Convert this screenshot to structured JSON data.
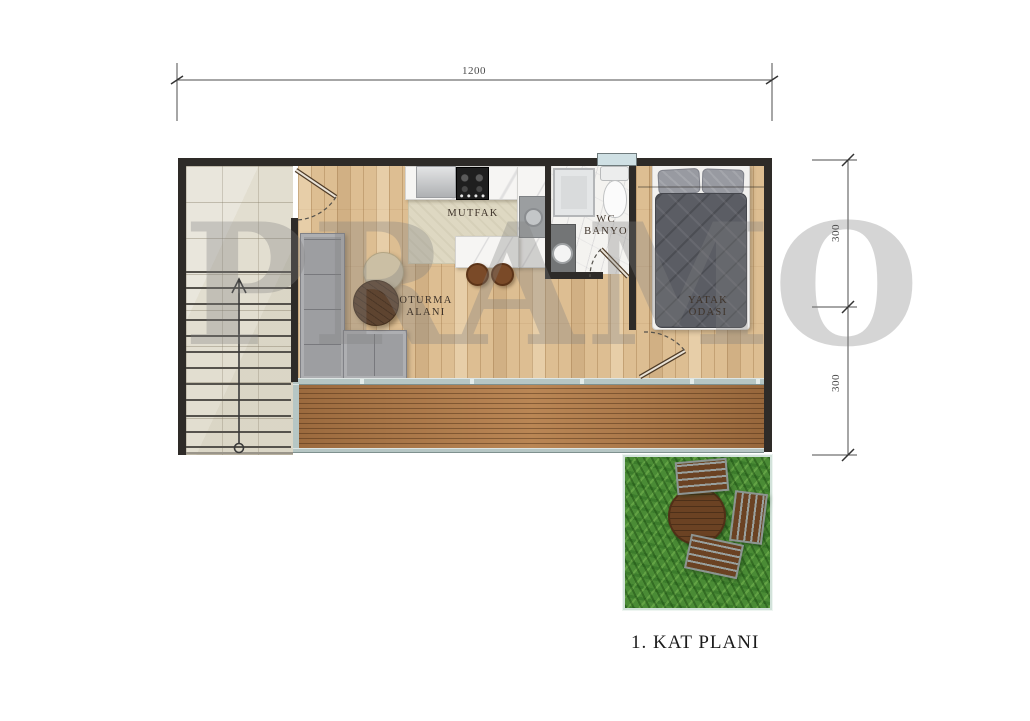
{
  "plan": {
    "watermark": "PRAMO",
    "title": "1. KAT PLANI",
    "rooms": {
      "kitchen": "MUTFAK",
      "wc_line1": "WC",
      "wc_line2": "BANYO",
      "living_line1": "OTURMA",
      "living_line2": "ALANI",
      "bedroom_line1": "YATAK",
      "bedroom_line2": "ODASI"
    },
    "dimensions": {
      "top_width": "1200",
      "right_upper": "300",
      "right_lower": "300"
    },
    "colors": {
      "wall": "#2e2b28",
      "wood_floor": "#ddbe92",
      "deck_wood": "#b07a49",
      "tile": "#e2ded0",
      "bath_floor": "#f4f3f0",
      "grass": "#4a8b35",
      "glass": "#b6c6c4",
      "watermark": "#808080",
      "label_text": "#3e332a",
      "dim_text": "#4a4a4a"
    }
  }
}
